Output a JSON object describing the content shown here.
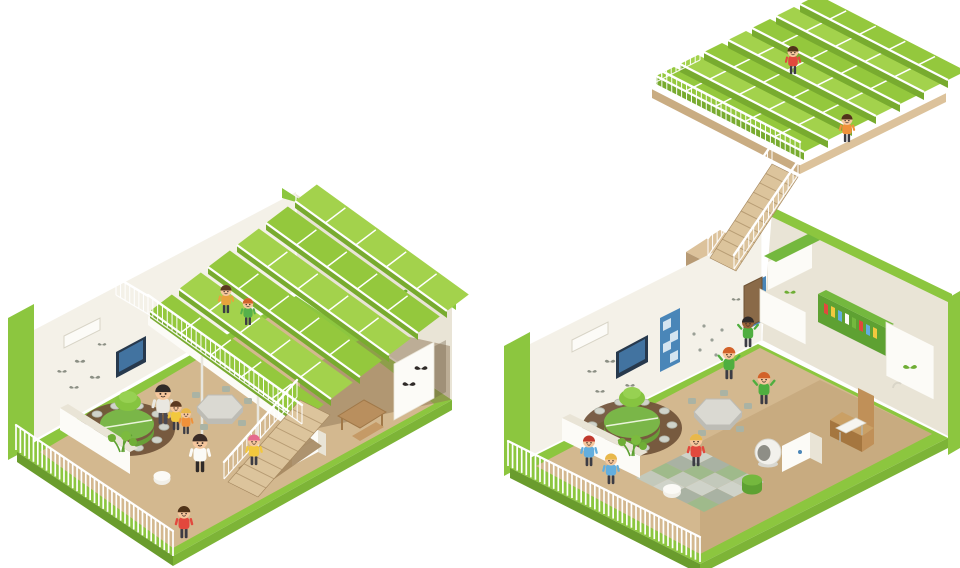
{
  "illustration": {
    "type": "isometric-architectural-cutaway",
    "subject": "two cutaway views of a kindergarten classroom with terraced green planting roof",
    "background": "#ffffff",
    "scenes": [
      {
        "id": "left",
        "description": "classroom with interior mezzanine of terraced green planters, wooden stair, round table, hex table, TV wall, picket fence edge"
      },
      {
        "id": "right",
        "description": "taller classroom connected by long wooden stair to a detached rooftop terrace of green planters; play corner, reading nook with sofa and bookshelf, climbing wall"
      }
    ]
  },
  "palette": {
    "green": "#8cc63f",
    "green_deep": "#6a9c2d",
    "green_mid": "#7db437",
    "bed_green": "#94c83d",
    "bed_green2": "#a3d24c",
    "bed_side": "#78ab2f",
    "cream": "#f4f1e8",
    "cream2": "#e9e4d6",
    "white_warm": "#fcfbf7",
    "decal_gray": "#8b8f84",
    "wood": "#d3b88f",
    "wood2": "#c2a277",
    "wood_dark": "#a4875f",
    "stair_wood": "#dcc49c",
    "navy": "#27394d",
    "screen_blue": "#4273a0",
    "blue": "#4a86b8",
    "blue_light": "#d4e4f0",
    "sofa": "#c09058",
    "sofa_dark": "#a5763f",
    "rug_brown": "#6f5138",
    "stool": "#d0d3ca",
    "stool_edge": "#b2b6ab",
    "table_green": "#7ab648",
    "table_green_dark": "#699f38",
    "hex_top": "#dad9d2",
    "hex_side": "#bdbcb5",
    "chair_gray": "#aab3a4"
  },
  "build": {
    "bedFields": [
      {
        "target": "g-left-beds",
        "name": "mezzanine-planter-terraces",
        "origin": [
          150,
          318
        ],
        "row": [
          152,
          110
        ],
        "step": [
          29,
          -22
        ],
        "rows": 6,
        "bedH": 7,
        "cells": 5
      },
      {
        "target": "g-right-beds",
        "name": "rooftop-planter-terraces",
        "origin": [
          656,
          84
        ],
        "row": [
          148,
          76
        ],
        "step": [
          24,
          -12
        ],
        "rows": 7,
        "bedH": 8,
        "cells": 5
      }
    ],
    "railings": [
      {
        "target": "g-left-rails",
        "from": [
          148,
          314
        ],
        "to": [
          302,
          424
        ],
        "h": 19,
        "n": 32
      },
      {
        "target": "g-left-rails",
        "from": [
          116,
          295
        ],
        "to": [
          148,
          314
        ],
        "h": 18,
        "n": 7
      },
      {
        "target": "g-left-rails",
        "from": [
          224,
          479
        ],
        "to": [
          297,
          397
        ],
        "h": 17,
        "n": 16
      },
      {
        "target": "g-right-rails",
        "from": [
          652,
          84
        ],
        "to": [
          800,
          160
        ],
        "h": 18,
        "n": 30
      },
      {
        "target": "g-right-rails",
        "from": [
          652,
          84
        ],
        "to": [
          700,
          60
        ],
        "h": 16,
        "n": 10
      },
      {
        "target": "g-right-rails",
        "from": [
          708,
          256
        ],
        "to": [
          772,
          162
        ],
        "h": 18,
        "n": 14
      },
      {
        "target": "g-right-rails",
        "from": [
          734,
          269
        ],
        "to": [
          798,
          175
        ],
        "h": 14,
        "n": 13
      }
    ],
    "fences": [
      {
        "target": "g-left-fence",
        "from": [
          16,
          450
        ],
        "to": [
          173,
          556
        ],
        "h": 25,
        "n": 36
      },
      {
        "target": "g-right-fence",
        "from": [
          508,
          466
        ],
        "to": [
          700,
          562
        ],
        "h": 25,
        "n": 42
      }
    ],
    "stairs": [
      {
        "target": "g-left-stairs",
        "from": [
          228,
          482
        ],
        "run": [
          72,
          -82
        ],
        "w": [
          30,
          15
        ],
        "steps": 9
      },
      {
        "target": "g-right-stairs",
        "from": [
          710,
          258
        ],
        "run": [
          62,
          -94
        ],
        "w": [
          26,
          13
        ],
        "steps": 10
      }
    ],
    "stoolRings": [
      {
        "target": "g-left-stools",
        "cx": 127,
        "cy": 427,
        "rx": 37,
        "ry": 22,
        "n": 10,
        "sr": 5
      },
      {
        "target": "g-right-stools",
        "cx": 632,
        "cy": 425,
        "rx": 40,
        "ry": 24,
        "n": 10,
        "sr": 5
      }
    ],
    "checkers": [
      {
        "target": "g-right-rug",
        "origin": [
          696,
          448
        ],
        "a": [
          17,
          8.5
        ],
        "b": [
          -15,
          7.5
        ],
        "nx": 4,
        "ny": 4,
        "colors": [
          "#cfd3c9",
          "#a9b2a3",
          "#9fba8b",
          "#c3c9bb"
        ]
      }
    ],
    "figures": [
      {
        "target": "g-left-kids",
        "x": 226,
        "y": 313,
        "s": 0.92,
        "shirt": "#e8a33c",
        "hair": "#5a3a22"
      },
      {
        "target": "g-left-kids",
        "x": 248,
        "y": 325,
        "s": 0.88,
        "shirt": "#56b14a",
        "hair": "#d2622a"
      },
      {
        "target": "g-left-kids",
        "x": 163,
        "y": 424,
        "s": 1.3,
        "shirt": "#e9e7e0",
        "pants": "#4a4a52",
        "hair": "#2f2a28"
      },
      {
        "target": "g-left-kids",
        "x": 176,
        "y": 430,
        "s": 0.95,
        "shirt": "#f2c83e",
        "hair": "#5a3a22"
      },
      {
        "target": "g-left-kids",
        "x": 186,
        "y": 434,
        "s": 0.85,
        "shirt": "#f0913a",
        "hair": "#e8b84b"
      },
      {
        "target": "g-left-kids",
        "x": 200,
        "y": 472,
        "s": 1.25,
        "shirt": "#fbfaf6",
        "pants": "#2f2a28",
        "hair": "#3a2c26"
      },
      {
        "target": "g-left-kids",
        "x": 254,
        "y": 465,
        "s": 1.0,
        "shirt": "#f2c83e",
        "hair": "#e56a8e"
      },
      {
        "target": "g-left-kids",
        "x": 184,
        "y": 538,
        "s": 1.05,
        "shirt": "#e2483d",
        "hair": "#4f3319"
      },
      {
        "target": "g-right-kids",
        "x": 793,
        "y": 74,
        "s": 0.92,
        "shirt": "#e2483d",
        "hair": "#4f3319"
      },
      {
        "target": "g-right-kids",
        "x": 847,
        "y": 142,
        "s": 0.92,
        "shirt": "#f0913a",
        "hair": "#4f3319"
      },
      {
        "target": "g-right-kids",
        "x": 748,
        "y": 347,
        "s": 1.0,
        "shirt": "#4fae3f",
        "skin": "#9a6238",
        "hair": "#2f2a28",
        "pose": "cheer"
      },
      {
        "target": "g-right-kids",
        "x": 729,
        "y": 379,
        "s": 1.05,
        "shirt": "#4fae3f",
        "hair": "#d2622a",
        "pose": "cheer"
      },
      {
        "target": "g-right-kids",
        "x": 764,
        "y": 404,
        "s": 1.05,
        "shirt": "#4fae3f",
        "hair": "#d2622a",
        "pose": "cheer"
      },
      {
        "target": "g-right-kids",
        "x": 696,
        "y": 466,
        "s": 1.05,
        "shirt": "#e2483d",
        "hair": "#e8b84b"
      },
      {
        "target": "g-right-kids",
        "x": 589,
        "y": 466,
        "s": 1.0,
        "shirt": "#63aede",
        "hair": "#c0392e"
      },
      {
        "target": "g-right-kids",
        "x": 611,
        "y": 484,
        "s": 1.0,
        "shirt": "#63aede",
        "hair": "#e8b84b"
      }
    ]
  }
}
